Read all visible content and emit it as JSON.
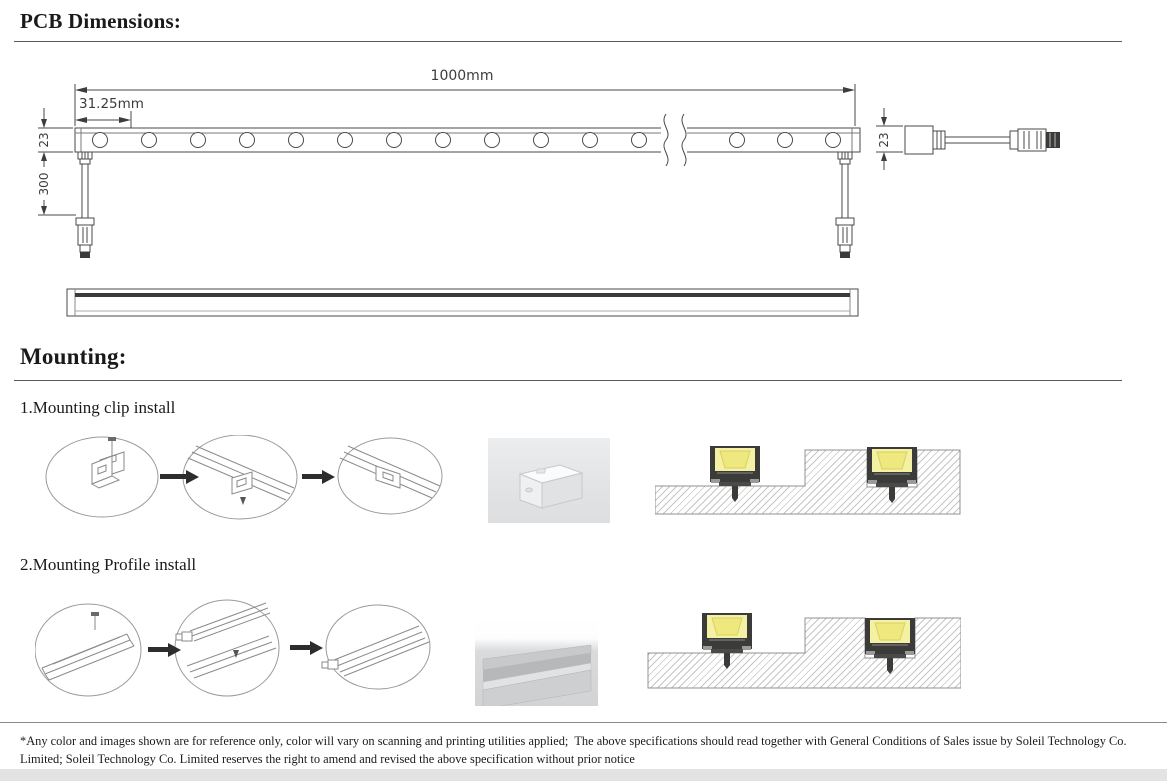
{
  "pcb": {
    "heading": "PCB Dimensions:"
  },
  "dims": {
    "total_length": "1000mm",
    "led_pitch": "31.25mm",
    "bar_height_left": "23",
    "cable_length": "300",
    "bar_height_right": "23"
  },
  "mounting": {
    "heading": "Mounting:",
    "step1_label": "1.Mounting clip install",
    "step2_label": "2.Mounting Profile install"
  },
  "footer": {
    "line1": "*Any color and images shown are for reference only, color will vary on scanning and printing utilities applied;  The above specifications should read together with General Conditions of Sales issue by Soleil Technology Co.",
    "line2": "Limited; Soleil Technology Co. Limited reserves the right to amend and revised the above specification without prior notice"
  },
  "colors": {
    "led_yellow": "#f4f0a4",
    "led_yellow_inner": "#efe87e",
    "housing_dark": "#3b3b39",
    "drawing_line": "#4a4a4a",
    "hatch_gray": "#c6c6c6",
    "photo_bg": "#e6e7e9",
    "bottom_strip": "#e3e3e3"
  }
}
